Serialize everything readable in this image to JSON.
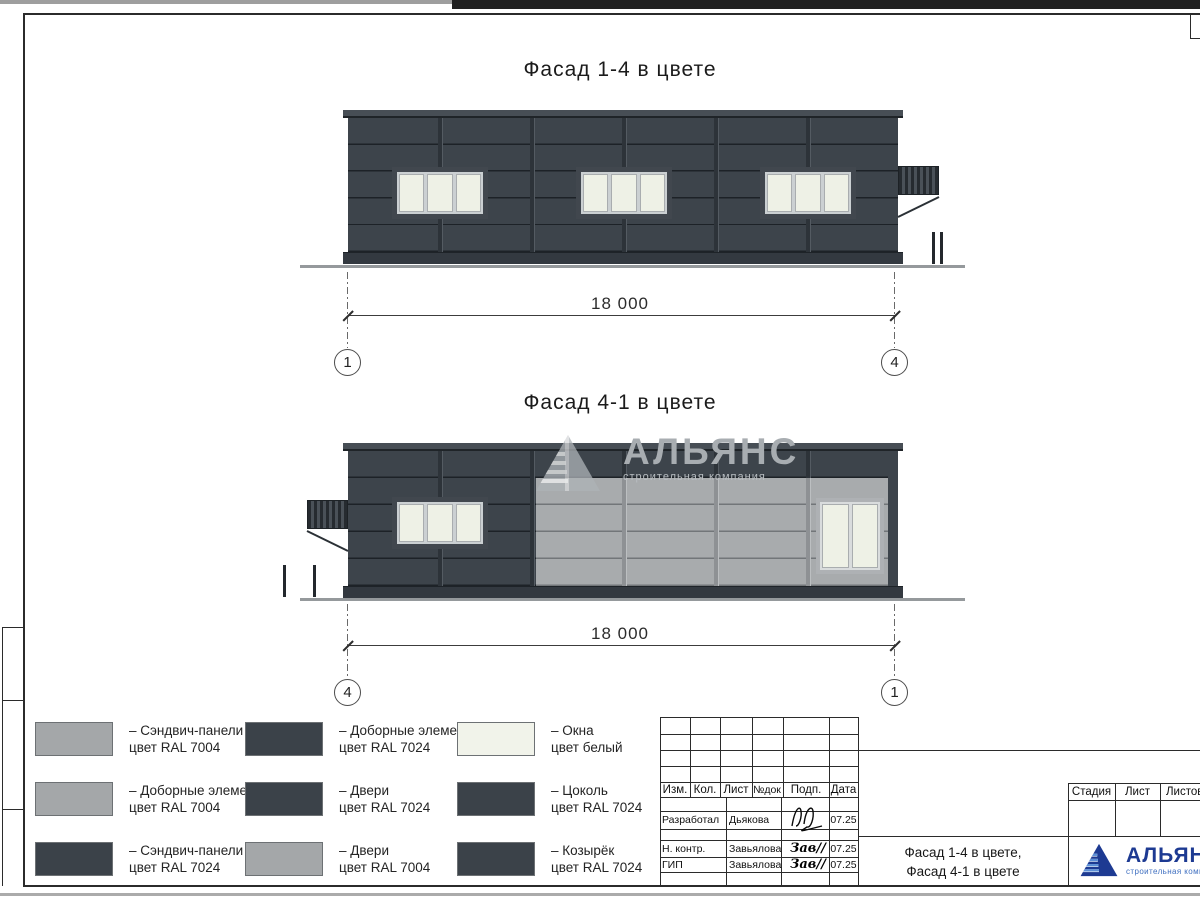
{
  "drawings": {
    "facade_top": {
      "title": "Фасад 1-4 в цвете",
      "dimension": "18 000",
      "axis_left": "1",
      "axis_right": "4"
    },
    "facade_bottom": {
      "title": "Фасад 4-1 в цвете",
      "dimension": "18 000",
      "axis_left": "4",
      "axis_right": "1"
    }
  },
  "watermark": {
    "title": "АЛЬЯНС",
    "subtitle": "строительная компания"
  },
  "colors": {
    "ral_7024": "#3d444b",
    "ral_7004": "#a8abad",
    "window_white": "#eef1e6",
    "plinth_dark": "#333940",
    "logo_blue": "#1d3a92",
    "logo_light_blue": "#5c8fd6"
  },
  "legend": {
    "items": [
      {
        "color": "#a4a7a9",
        "line1": "– Сэндвич-панели",
        "line2": "цвет RAL 7004"
      },
      {
        "color": "#3b4249",
        "line1": "– Доборные элементы",
        "line2": "цвет RAL 7024"
      },
      {
        "color": "#f1f3ea",
        "line1": "– Окна",
        "line2": "цвет белый"
      },
      {
        "color": "#a4a7a9",
        "line1": "– Доборные элементы",
        "line2": "цвет RAL 7004"
      },
      {
        "color": "#3b4249",
        "line1": "– Двери",
        "line2": "цвет RAL 7024"
      },
      {
        "color": "#3b4249",
        "line1": "– Цоколь",
        "line2": "цвет RAL 7024"
      },
      {
        "color": "#3b4249",
        "line1": "– Сэндвич-панели",
        "line2": "цвет RAL 7024"
      },
      {
        "color": "#a4a7a9",
        "line1": "– Двери",
        "line2": "цвет RAL 7004"
      },
      {
        "color": "#3b4249",
        "line1": "– Козырёк",
        "line2": "цвет RAL 7024"
      }
    ]
  },
  "title_block": {
    "rev_headers": [
      "Изм.",
      "Кол.",
      "Лист",
      "№док",
      "Подп.",
      "Дата"
    ],
    "people": [
      {
        "role": "Разработал",
        "name": "Дьякова",
        "sign": "",
        "date": "07.25"
      },
      {
        "role": "Н. контр.",
        "name": "Завьялова",
        "sign": "Зав",
        "date": "07.25"
      },
      {
        "role": "ГИП",
        "name": "Завьялова",
        "sign": "Зав",
        "date": "07.25"
      }
    ],
    "stage_headers": [
      "Стадия",
      "Лист",
      "Листов"
    ],
    "doc_title_line1": "Фасад 1-4 в цвете,",
    "doc_title_line2": "Фасад 4-1 в цвете",
    "logo": {
      "title": "АЛЬЯНС",
      "subtitle": "строительная компания"
    }
  }
}
